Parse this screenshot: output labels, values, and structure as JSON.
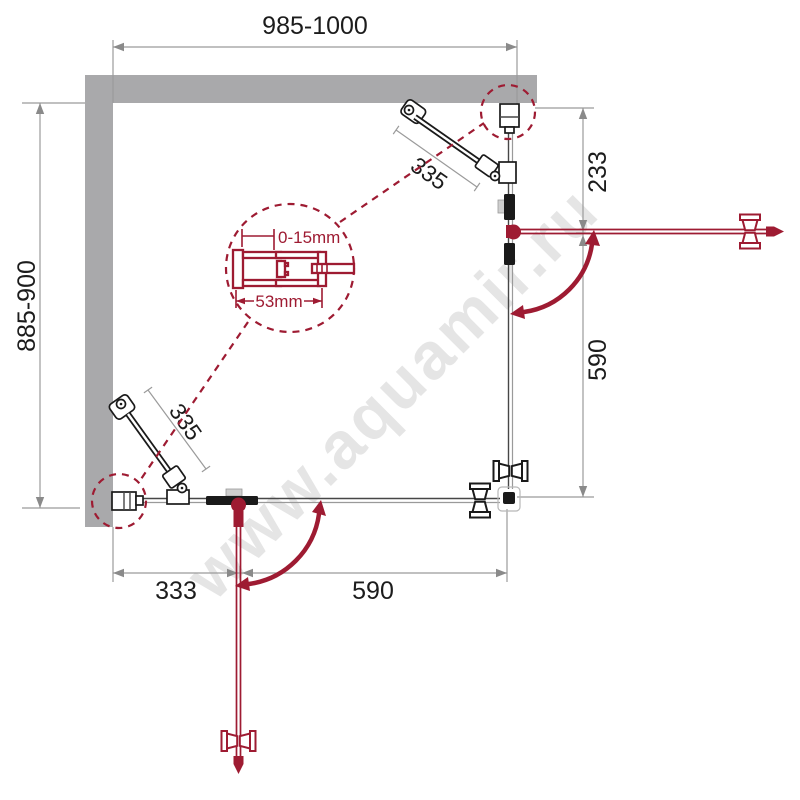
{
  "diagram": {
    "watermark": "www.aquamir.ru",
    "dimensions": {
      "top": "985-1000",
      "left": "885-900",
      "right_upper": "233",
      "right_lower": "590",
      "bottom_left": "333",
      "bottom_right": "590",
      "top_arm": "335",
      "bottom_arm": "335"
    },
    "detail": {
      "gap_range": "0-15mm",
      "profile_width": "53mm"
    },
    "colors": {
      "accent": "#9e1b32",
      "wall": "#a9a9ab",
      "dim_line": "#9b9b9b",
      "hardware": "#1a1a1a",
      "watermark_color": "#d4d4d4"
    }
  }
}
